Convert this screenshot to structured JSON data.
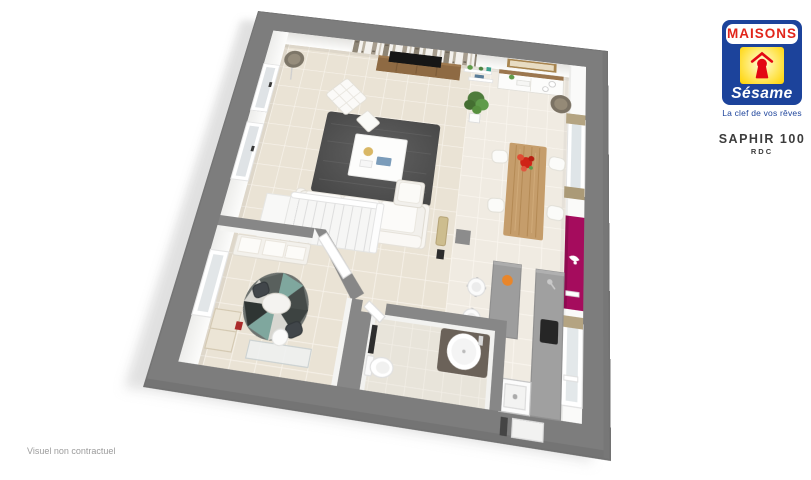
{
  "page": {
    "background": "#ffffff"
  },
  "branding": {
    "logo": {
      "brand_top": "MAISONS",
      "brand_script": "Sésame",
      "tagline": "La clef de vos rêves",
      "icon": "house-keyhole-icon",
      "colors": {
        "blue": "#1c439b",
        "red": "#e1251b",
        "keyhole_red": "#e30613",
        "yellow": "#ffd200",
        "yellow_light": "#fdf3b3"
      }
    },
    "plan_title": "SAPHIR 100",
    "plan_level": "RDC"
  },
  "footer": {
    "disclaimer": "Visuel non contractuel"
  },
  "floor_plan": {
    "view": "3d-dollhouse-floorplan-ground-floor",
    "colors": {
      "wall_gray": "#7d7d7d",
      "interior_wall_gray": "#878787",
      "floor_tile_beige": "#eae3d5",
      "floor_tile_light": "#f0ebe2",
      "accent_wall_magenta": "#a50c5d",
      "wood": "#c59d6b",
      "rug_dark_gray": "#4f4f4f"
    },
    "elements": [
      "sofa",
      "armchair",
      "coffee-table",
      "rug",
      "tv-stand",
      "tv",
      "birch-wallpaper",
      "floor-lamp",
      "wall-shelves",
      "ficus-plant",
      "sideboard",
      "mirror",
      "dining-table",
      "dining-chairs",
      "flower-centerpiece",
      "magenta-accent-wall",
      "wall-sconce",
      "window-curtains",
      "kitchen-counter",
      "sink",
      "cooktop",
      "bar-island",
      "bar-stools",
      "column",
      "staircase",
      "office-bench",
      "round-rug",
      "side-table",
      "office-chairs",
      "cabinet",
      "desk",
      "interior-door",
      "washbasin",
      "toilet",
      "towel-radiator",
      "windows",
      "entry-door"
    ]
  }
}
